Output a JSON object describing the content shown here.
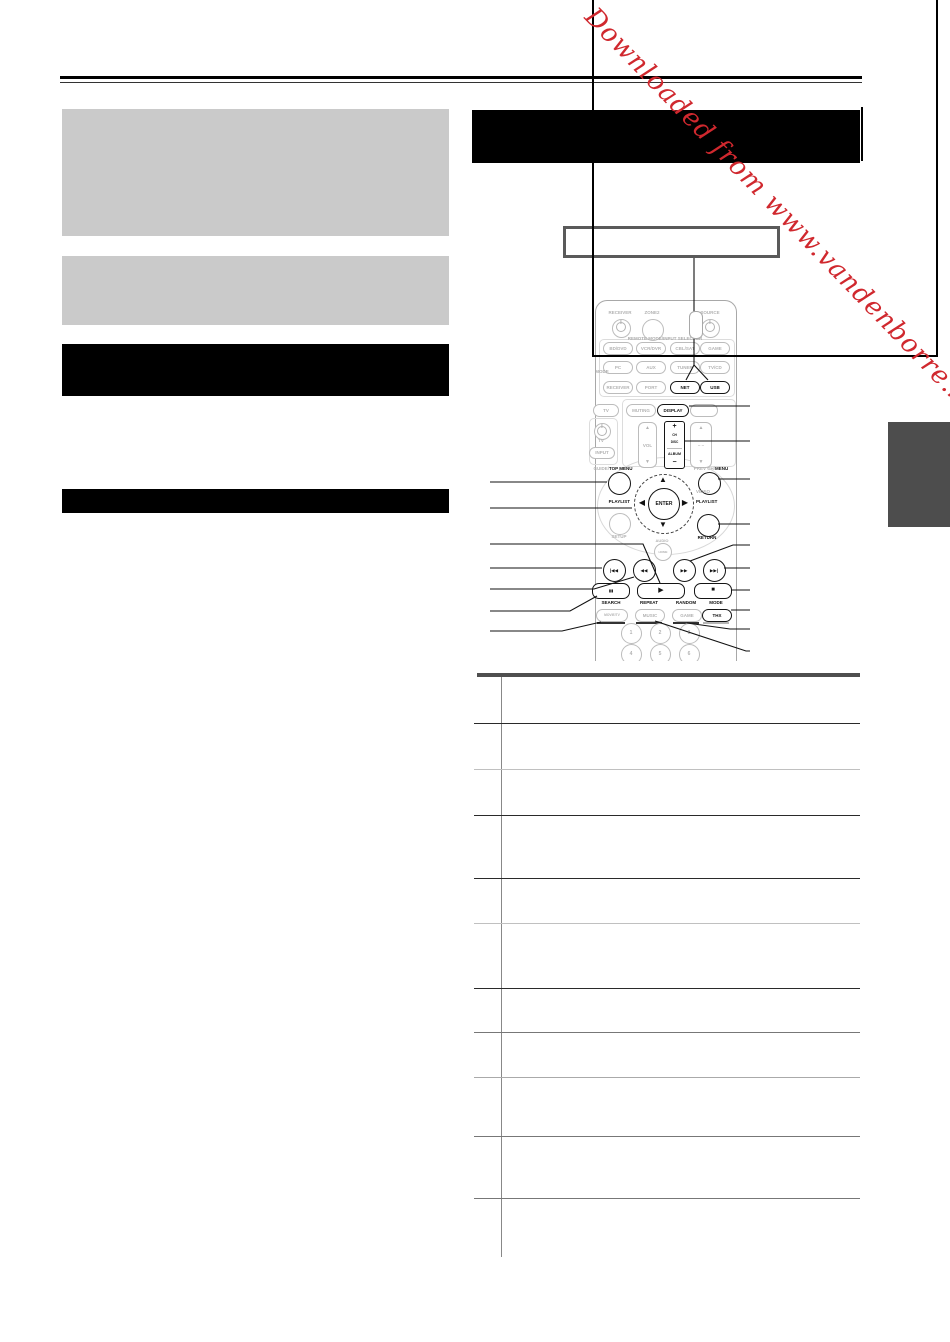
{
  "watermark": {
    "text": "Downloaded from www.vandenborre.be",
    "color": "#d0282e"
  },
  "remote": {
    "power_row": {
      "receiver": "RECEIVER",
      "zone2": "ZONE2",
      "source": "SOURCE"
    },
    "selector_label": "REMOTE MODE/INPUT SELECTOR",
    "mode_label": "MODE",
    "input_rows": {
      "row1": [
        "BD/DVD",
        "VCR/DVR",
        "CBL/SAT",
        "GAME"
      ],
      "row2": [
        "PC",
        "AUX",
        "TUNER",
        "TV/CD"
      ],
      "row3": [
        "RECEIVER",
        "PORT",
        "NET",
        "USB"
      ],
      "row4": [
        "TV",
        "MUTING",
        "DISPLAY"
      ]
    },
    "tv_block": {
      "tv": "TV",
      "input": "INPUT"
    },
    "vol_label": "VOL",
    "album_rocker": {
      "plus": "+",
      "ch": "CH",
      "disc": "DISC",
      "album": "ALBUM",
      "minus": "−"
    },
    "menus": {
      "guide": "GUIDE/",
      "top_menu": "TOP MENU",
      "prev_ch": "PREV CH/",
      "menu": "MENU"
    },
    "playlist_left": "PLAYLIST",
    "playlist_right": "PLAYLIST",
    "video_label": "VIDEO",
    "enter_label": "ENTER",
    "setup_label": "SETUP",
    "return_label": "RETURN",
    "audio_label": "AUDIO",
    "home_label": "HOME",
    "function_labels": [
      "SEARCH",
      "REPEAT",
      "RANDOM",
      "MODE"
    ],
    "mode_buttons": [
      "MOVIE/TV",
      "MUSIC",
      "GAME",
      "THX"
    ],
    "digits": [
      "1",
      "2",
      "3",
      "4",
      "5",
      "6"
    ],
    "glyphs": {
      "up": "▲",
      "down": "▼",
      "left": "◀",
      "right": "▶",
      "prev": "|◀◀",
      "rew": "◀◀",
      "ff": "▶▶",
      "next": "▶▶|",
      "play": "▶",
      "stop": "■",
      "pause": "▮▮",
      "dashes": "– –"
    }
  },
  "colors": {
    "accent_red": "#d0282e",
    "bar_black": "#000000",
    "block_gray": "#cacaca",
    "tab_gray": "#4d4d4d"
  }
}
